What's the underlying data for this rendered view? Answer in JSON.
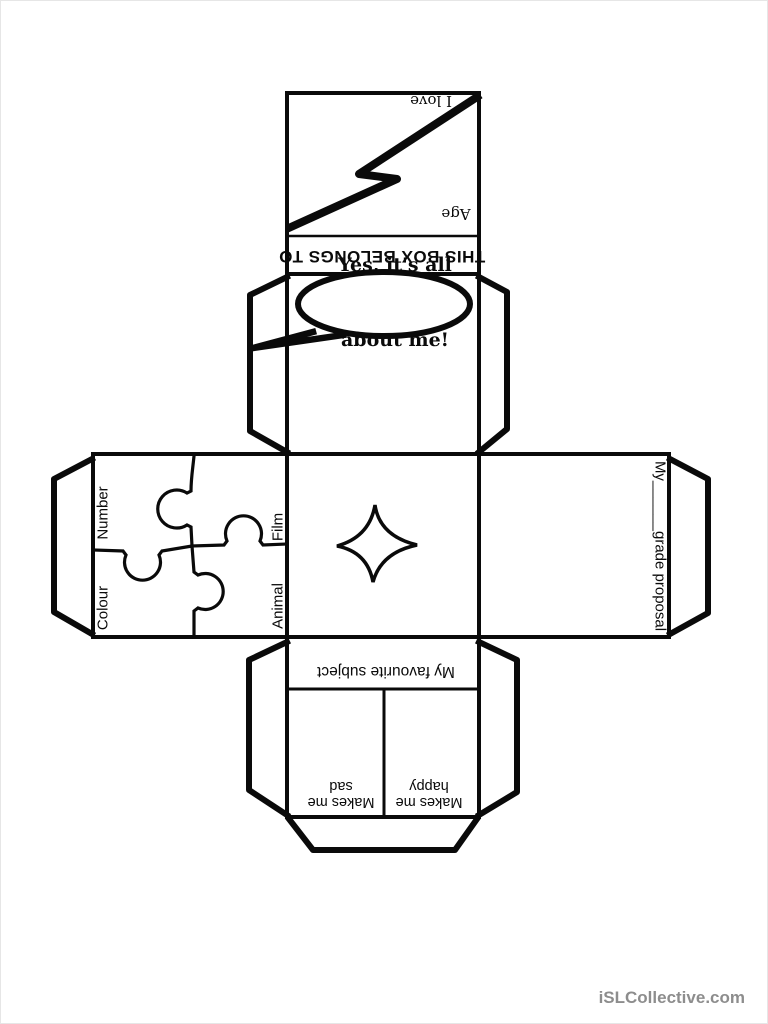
{
  "page": {
    "paper_color": "#ffffff",
    "ink_color": "#0a0a0a",
    "watermark": "iSLCollective.com",
    "watermark_color": "#8d8d8d"
  },
  "net": {
    "top_face": {
      "love_label": "I love",
      "age_label": "Age",
      "icon": "lightning-bolt"
    },
    "ownership_band": {
      "label": "THIS BOX BELONGS TO"
    },
    "speech_face": {
      "bubble_line1": "Yes, it's all",
      "bubble_line2": "about me!",
      "icon": "speech-bubble"
    },
    "puzzle_face": {
      "top_left_label": "Number",
      "bottom_left_label": "Colour",
      "top_right_label": "Film",
      "bottom_right_label": "Animal",
      "icon": "jigsaw-grid"
    },
    "star_face": {
      "icon": "four-point-star"
    },
    "proposal_face": {
      "label": "My______grade proposal"
    },
    "subject_face": {
      "header": "My favourite subject",
      "left_line1": "Makes me",
      "left_line2": "sad",
      "right_line1": "Makes me",
      "right_line2": "happy"
    }
  }
}
